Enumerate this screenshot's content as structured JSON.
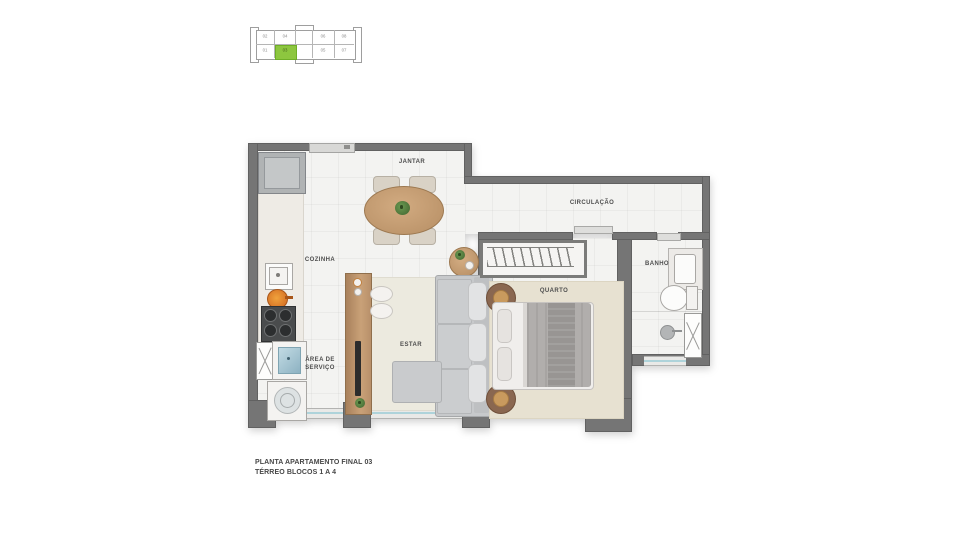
{
  "keyplan": {
    "units_top": [
      "02",
      "04",
      "06",
      "08"
    ],
    "units_bottom": [
      "01",
      "03",
      "05",
      "07"
    ],
    "selected_unit": "03",
    "highlight_color": "#8dc63f"
  },
  "rooms": {
    "jantar": "JANTAR",
    "cozinha": "COZINHA",
    "circulacao": "CIRCULAÇÃO",
    "banho": "BANHO",
    "quarto": "QUARTO",
    "estar": "ESTAR",
    "area_servico_line1": "ÁREA DE",
    "area_servico_line2": "SERVIÇO"
  },
  "caption": {
    "line1": "PLANTA APARTAMENTO FINAL 03",
    "line2": "TÉRREO BLOCOS 1 A 4"
  },
  "colors": {
    "wall": "#757575",
    "floor": "#f3f3f1",
    "keyplan_highlight": "#8dc63f",
    "window_glass": "#aed3da",
    "wood": "#c49b73",
    "rug_estar": "#eceadf",
    "rug_quarto": "#e7e1d1",
    "sofa_gray": "#c7c9cb",
    "plant_green": "#4e7d3a",
    "pan_orange": "#e8832a",
    "laundry_blue": "#a4c6d2"
  }
}
